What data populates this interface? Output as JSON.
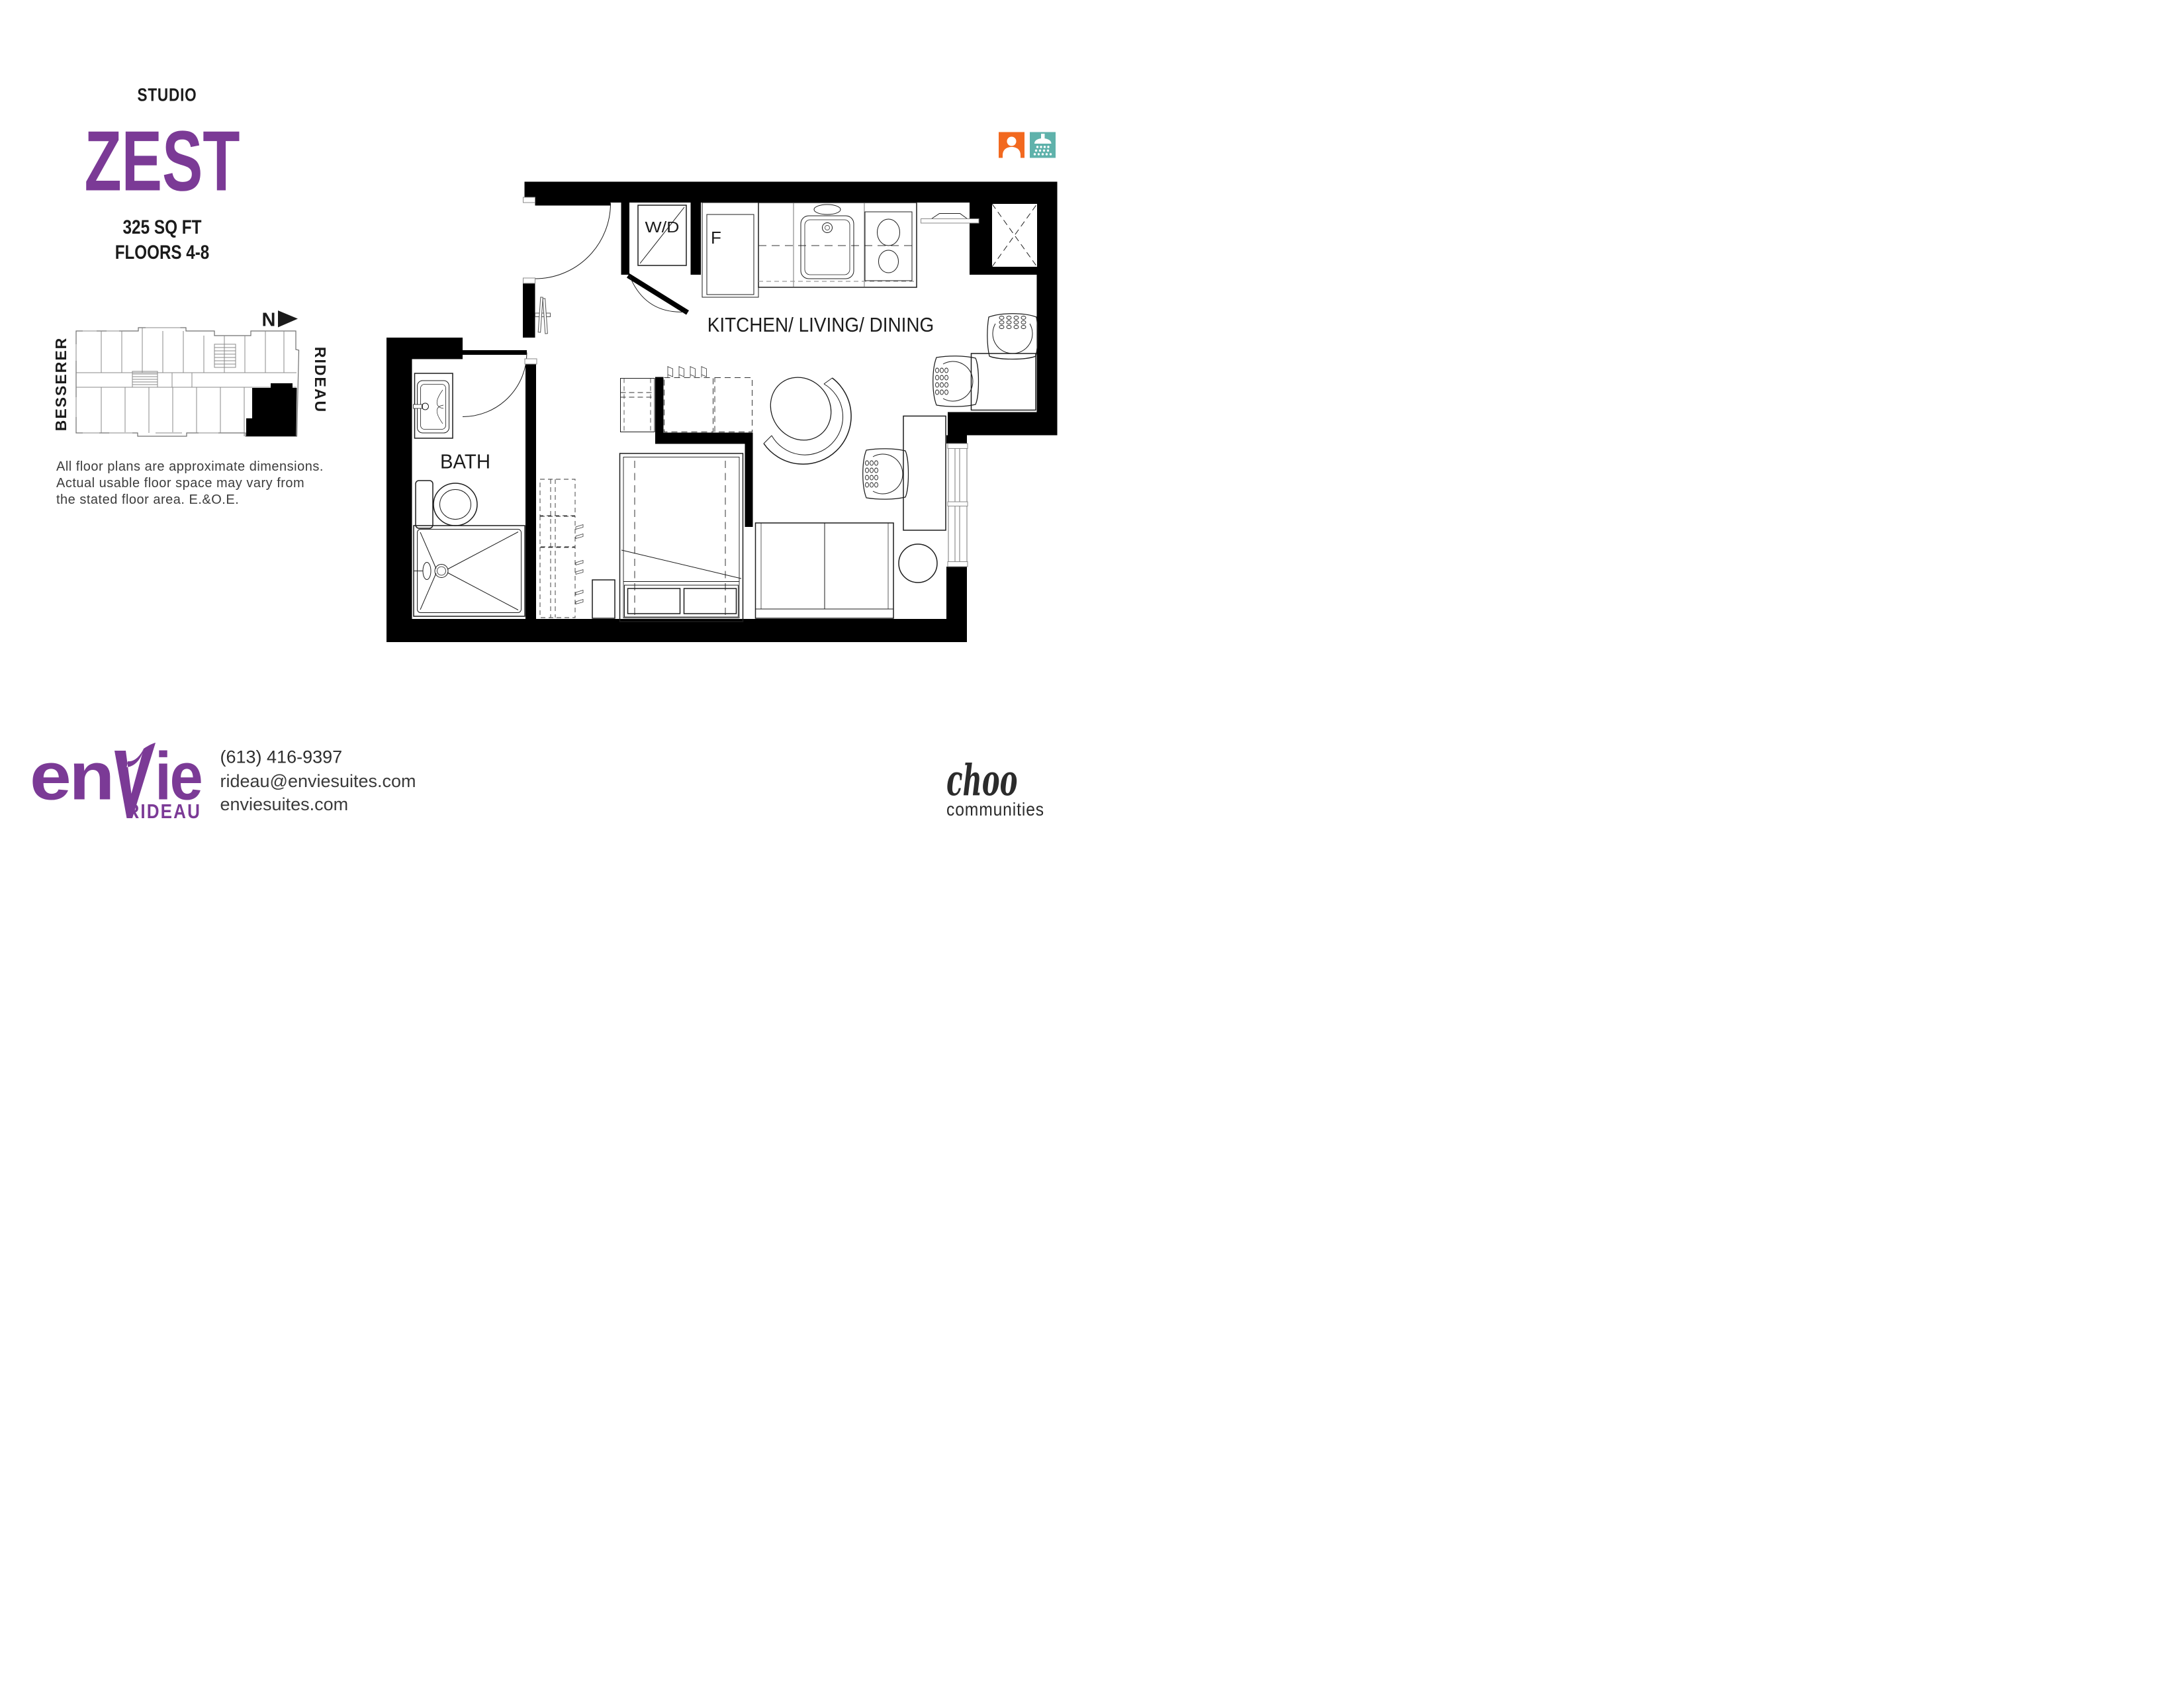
{
  "colors": {
    "purple": "#7B3A96",
    "orange": "#F2691F",
    "teal": "#5FB2AB",
    "ink": "#1b1b1b",
    "gray_text": "#3c3c3c"
  },
  "header": {
    "unit_type": "STUDIO",
    "unit_name": "ZEST",
    "area": "325 SQ FT",
    "floors": "FLOORS 4-8"
  },
  "keyplan": {
    "north_label": "N",
    "street_left": "BESSERER",
    "street_right": "RIDEAU"
  },
  "disclaimer": {
    "line1": "All floor plans are approximate dimensions.",
    "line2": "Actual usable floor space may vary from",
    "line3": "the stated floor area. E.&O.E."
  },
  "plan": {
    "room_main": "KITCHEN/ LIVING/ DINING",
    "room_bath": "BATH",
    "washer_dryer": "W/D",
    "fridge": "F"
  },
  "footer": {
    "brand_en": "en",
    "brand_ie": "ie",
    "brand_sub": "RIDEAU",
    "phone": "(613) 416-9397",
    "email": "rideau@enviesuites.com",
    "website": "enviesuites.com",
    "partner_script": "choo",
    "partner_word": "communities"
  }
}
